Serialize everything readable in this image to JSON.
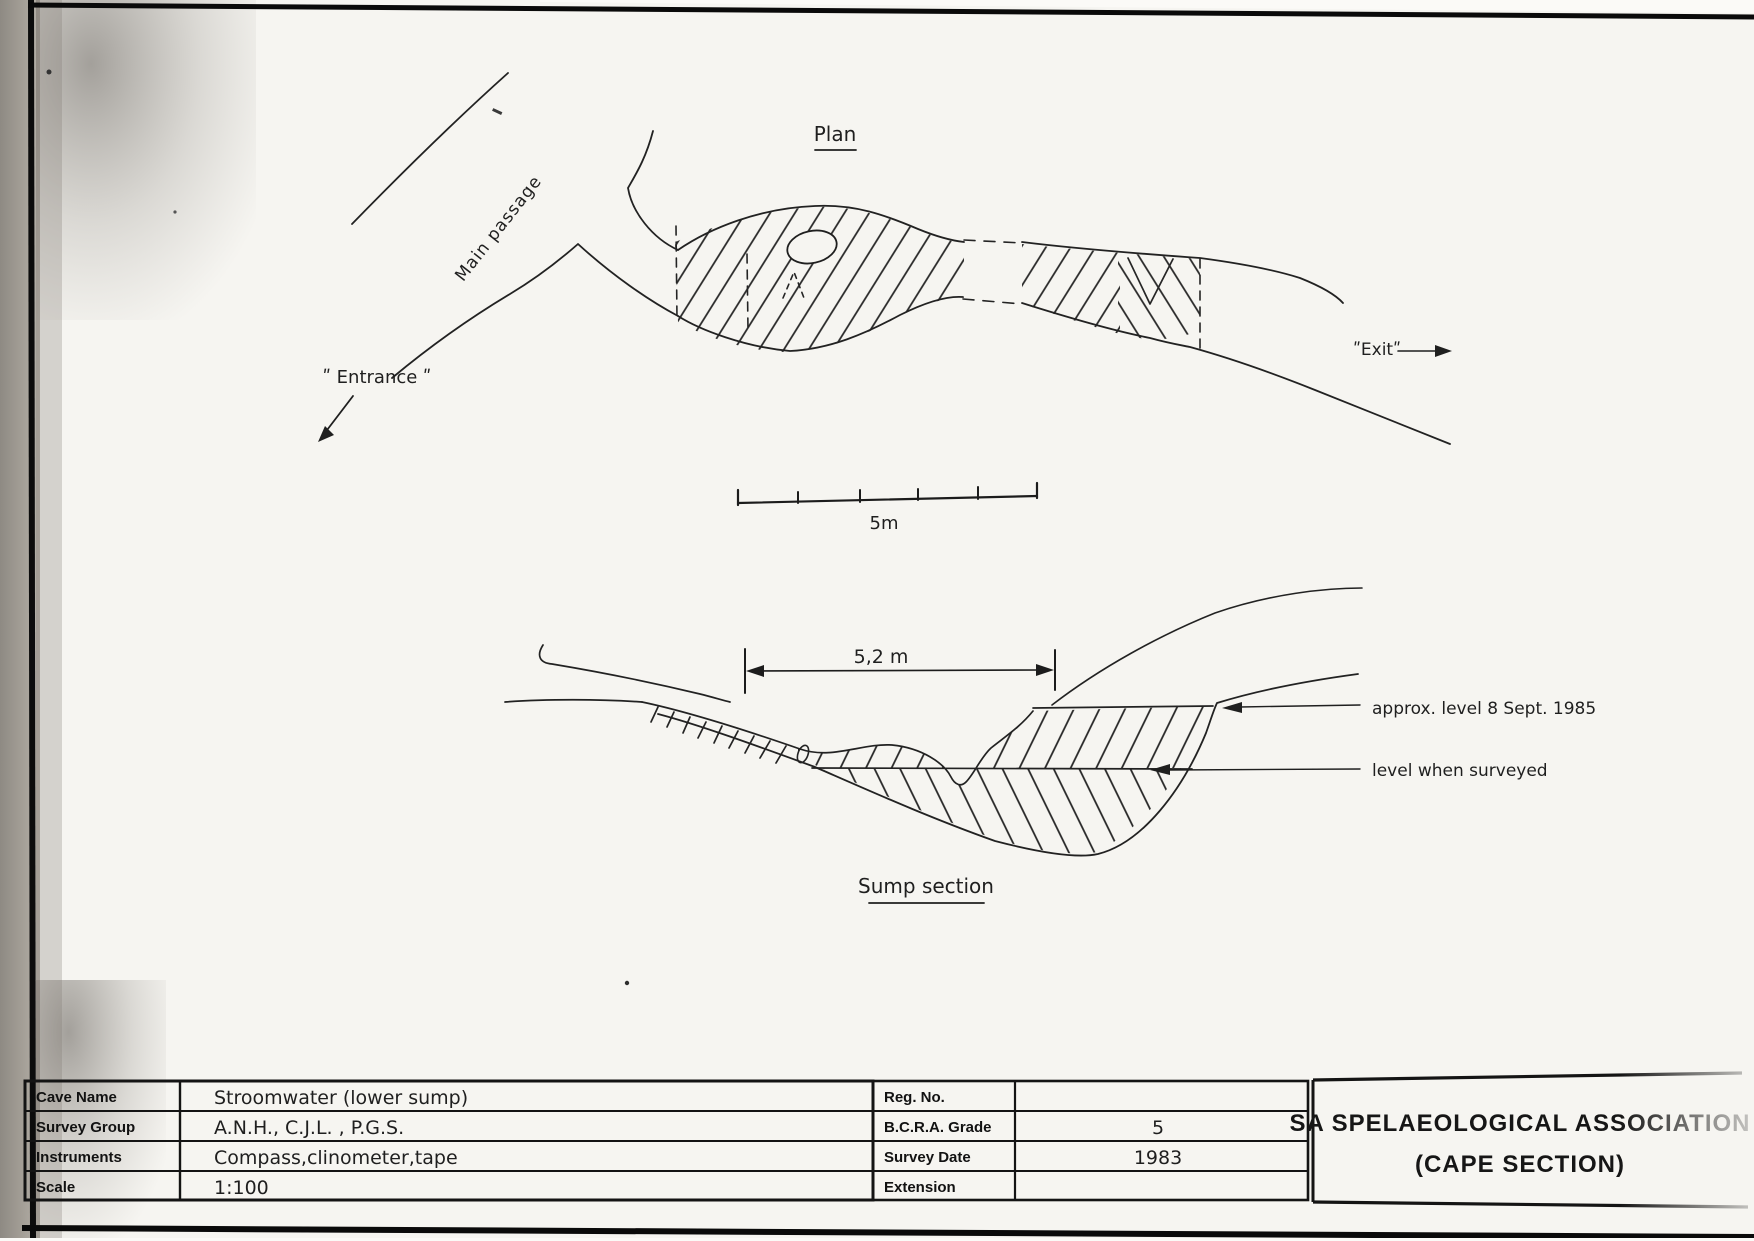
{
  "plan": {
    "title": "Plan",
    "main_passage_label": "Main passage",
    "entrance_label": "ʺ Entrance ʺ",
    "exit_label": "ʺExitʺ",
    "scale_bar_label": "5m"
  },
  "section": {
    "title": "Sump section",
    "width_dimension": "5,2 m",
    "approx_level_label": "approx. level  8 Sept. 1985",
    "surveyed_level_label": "level when surveyed"
  },
  "title_block": {
    "fields": [
      {
        "label": "Cave Name",
        "value": "Stroomwater  (lower sump)"
      },
      {
        "label": "Survey Group",
        "value": "A.N.H., C.J.L. , P.G.S."
      },
      {
        "label": "Instruments",
        "value": "Compass,clinometer,tape"
      },
      {
        "label": "Scale",
        "value": "1:100"
      }
    ],
    "meta_fields": [
      {
        "label": "Reg. No.",
        "value": ""
      },
      {
        "label": "B.C.R.A. Grade",
        "value": "5"
      },
      {
        "label": "Survey Date",
        "value": "1983"
      },
      {
        "label": "Extension",
        "value": ""
      }
    ],
    "organization_line1": "SA SPELAEOLOGICAL ASSOCIATION",
    "organization_line2": "(CAPE SECTION)"
  }
}
